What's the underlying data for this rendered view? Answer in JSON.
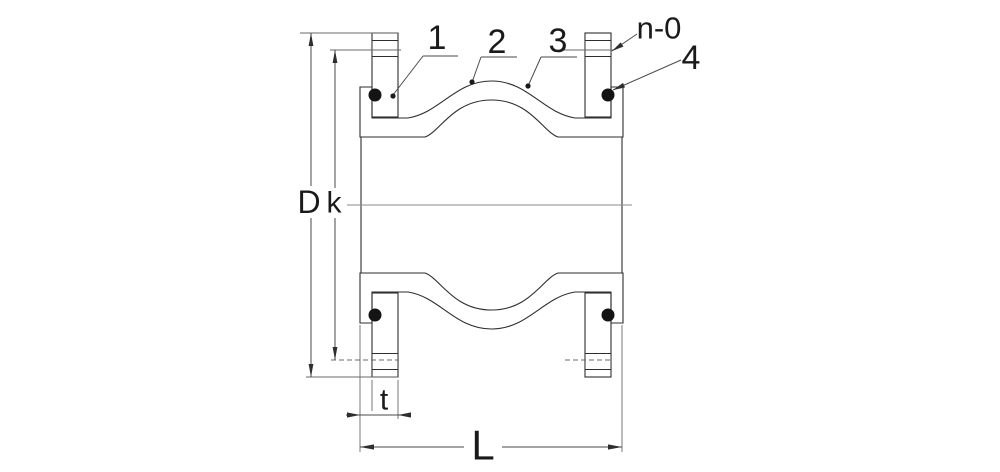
{
  "callouts": {
    "c1": "1",
    "c2": "2",
    "c3": "3",
    "c4": "4",
    "bolt": "n-0"
  },
  "dims": {
    "D": "D",
    "k": "k",
    "t": "t",
    "L": "L"
  },
  "colors": {
    "background": "#ffffff",
    "part_line": "#2e2e2e",
    "dimension_line": "#4a4a4a",
    "hatch": "#4a4a4a",
    "rubber_dots": "#3f3f3f",
    "text": "#1a1a1a"
  }
}
